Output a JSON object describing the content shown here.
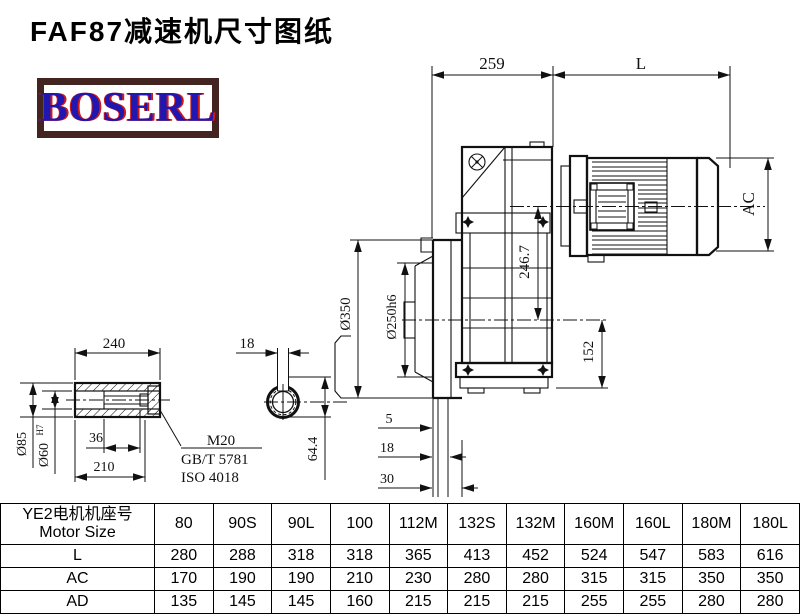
{
  "title": "FAF87减速机尺寸图纸",
  "logo": {
    "text": "BOSERL"
  },
  "colors": {
    "line": "#111111",
    "logo_text": "#2016b0",
    "logo_accent": "#cc1a1a",
    "logo_border": "#432420"
  },
  "drawing": {
    "dims": {
      "top_width": "259",
      "motor_length": "L",
      "motor_diameter": "AC",
      "axis_height": "246.7",
      "flange_diameter": "Ø350",
      "spigot_diameter": "Ø250h6",
      "base_height": "152",
      "offset_a": "5",
      "offset_b": "18",
      "offset_c": "30",
      "shaft_length": "240",
      "shaft_diameter": "Ø85",
      "bore_diameter": "Ø60",
      "bore_tolerance": "H7",
      "thread_depth": "36",
      "hub_length": "210",
      "keyway_width": "18",
      "keyway_height": "64.4",
      "bolt_spec": "M20",
      "bolt_standard": "GB/T 5781",
      "bolt_iso": "ISO 4018"
    }
  },
  "table": {
    "header": {
      "line1": "YE2电机机座号",
      "line2": "Motor Size"
    },
    "columns": [
      "80",
      "90S",
      "90L",
      "100",
      "112M",
      "132S",
      "132M",
      "160M",
      "160L",
      "180M",
      "180L"
    ],
    "rows": [
      {
        "label": "L",
        "values": [
          "280",
          "288",
          "318",
          "318",
          "365",
          "413",
          "452",
          "524",
          "547",
          "583",
          "616"
        ]
      },
      {
        "label": "AC",
        "values": [
          "170",
          "190",
          "190",
          "210",
          "230",
          "280",
          "280",
          "315",
          "315",
          "350",
          "350"
        ]
      },
      {
        "label": "AD",
        "values": [
          "135",
          "145",
          "145",
          "160",
          "215",
          "215",
          "215",
          "255",
          "255",
          "280",
          "280"
        ]
      }
    ]
  }
}
